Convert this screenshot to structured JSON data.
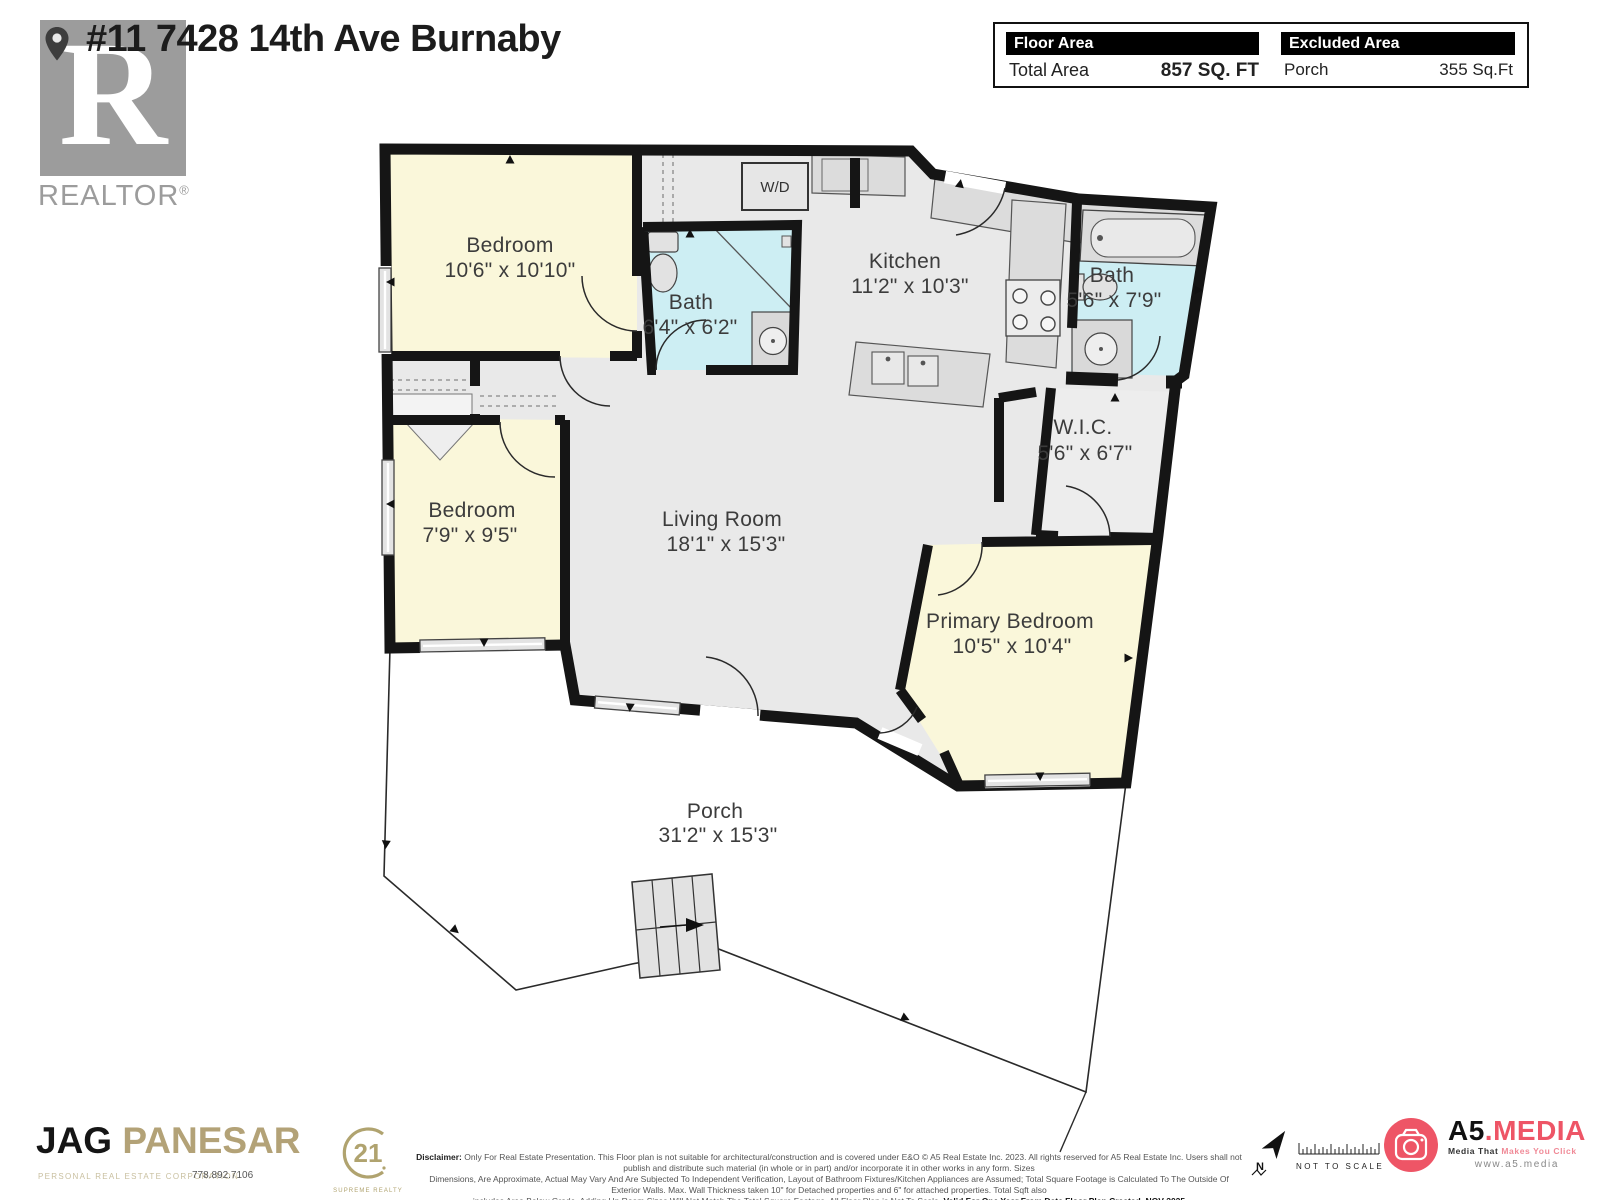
{
  "header": {
    "title": "#11 7428 14th Ave Burnaby",
    "realtor": {
      "letter": "R",
      "wordmark": "REALTOR",
      "reg": "®"
    },
    "area_box": {
      "floor_area_label": "Floor Area",
      "total_area_label": "Total Area",
      "total_area_value": "857 SQ. FT",
      "excluded_label": "Excluded Area",
      "excluded_name": "Porch",
      "excluded_value": "355 Sq.Ft"
    }
  },
  "floorplan": {
    "rooms": {
      "bedroom1": {
        "name": "Bedroom",
        "dims": "10'6\" x 10'10\""
      },
      "bath1": {
        "name": "Bath",
        "dims": "6'4\" x 6'2\""
      },
      "kitchen": {
        "name": "Kitchen",
        "dims": "11'2\" x 10'3\""
      },
      "bath2": {
        "name": "Bath",
        "dims": "5'6\" x 7'9\""
      },
      "wic": {
        "name": "W.I.C.",
        "dims": "5'6\" x 6'7\""
      },
      "bedroom2": {
        "name": "Bedroom",
        "dims": "7'9\" x 9'5\""
      },
      "living": {
        "name": "Living Room",
        "dims": "18'1\" x 15'3\""
      },
      "primary": {
        "name": "Primary Bedroom",
        "dims": "10'5\" x 10'4\""
      },
      "porch": {
        "name": "Porch",
        "dims": "31'2\" x 15'3\""
      },
      "wd": {
        "name": "W/D"
      }
    },
    "colors": {
      "wall": "#151515",
      "bedroom_fill": "#faf7da",
      "bath_fill": "#cdeef3",
      "floor_fill": "#e9e9e9"
    }
  },
  "footer": {
    "agent_first": "JAG",
    "agent_last": "PANESAR",
    "agent_subtitle": "PERSONAL REAL ESTATE CORPORATION",
    "agent_phone": "778.892.7106",
    "brokerage_number": "21",
    "brokerage_name": "SUPREME REALTY",
    "disclaimer": {
      "label": "Disclaimer:",
      "line1": "Only For Real Estate Presentation. This Floor plan is not suitable for architectural/construction and is covered under E&O © A5 Real Estate Inc. 2023. All rights reserved for A5 Real Estate Inc. Users shall not publish and distribute such material (in whole or in part) and/or incorporate it in other works in any form. Sizes",
      "line2": "Dimensions, Are Approximate, Actual May Vary And Are Subjected To Independent Verification, Layout of Bathroom Fixtures/Kitchen Appliances are Assumed; Total Square Footage is Calculated To The Outside Of Exterior Walls. Max. Wall Thickness taken 10\" for Detached properties and 6\" for attached properties. Total Sqft also",
      "line3": "includes Area Below Grade. Adding Up Room Sizes Will Not Match The Total Square Footage. All Floor Plan is Not To Scale.",
      "line3_bold": "Valid For One Year From Date Floor Plan Created. NOV 2025"
    },
    "compass_label": "N",
    "not_to_scale": "NOT TO SCALE",
    "a5": {
      "name_black": "A5",
      "name_pink": ".MEDIA",
      "tagline_dark": "Media That",
      "tagline_pink": " Makes You Click",
      "url": "www.a5.media",
      "brand_color": "#ee5566"
    }
  }
}
